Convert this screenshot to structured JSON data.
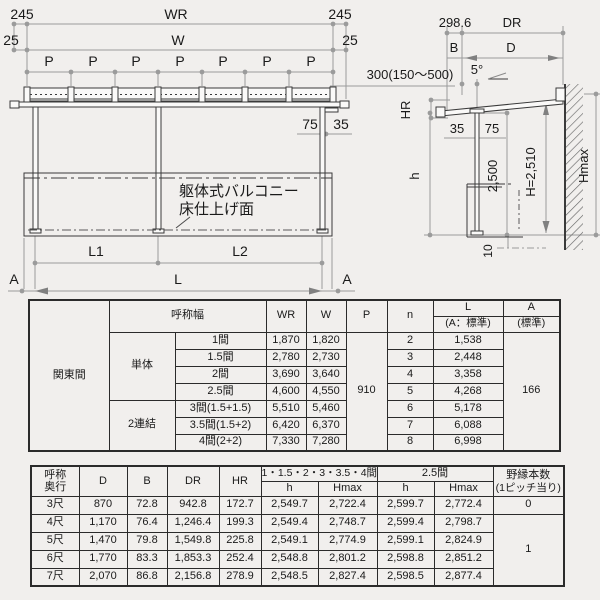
{
  "colors": {
    "structure_line": "#3a3a3a",
    "dimension_line": "#9b9b9b",
    "text": "#1a1a1a",
    "background": "#f1efed",
    "table_border": "#2b2b2b"
  },
  "front_view": {
    "dim_245_left": "245",
    "dim_wr": "WR",
    "dim_245_right": "245",
    "dim_25_left": "25",
    "dim_w": "W",
    "dim_25_right": "25",
    "pitch_label": "P",
    "dim_75": "75",
    "dim_35": "35",
    "note_line1": "躯体式バルコニー",
    "note_line2": "床仕上げ面",
    "dim_l1": "L1",
    "dim_l2": "L2",
    "dim_l": "L",
    "section_left": "A",
    "section_right": "A"
  },
  "side_view": {
    "dim_298_6": "298.6",
    "dim_dr": "DR",
    "dim_b": "B",
    "dim_d": "D",
    "dim_bracket": "300(150〜500)",
    "dim_slope": "5°",
    "dim_hr": "HR",
    "dim_35": "35",
    "dim_75": "75",
    "dim_h": "h",
    "dim_2500": "2,500",
    "dim_h2510": "H=2,510",
    "dim_hmax": "Hmax",
    "dim_10": "10"
  },
  "spec_table": {
    "region": "関東間",
    "header": {
      "width_label": "呼称幅",
      "wr": "WR",
      "w": "W",
      "p": "P",
      "n": "n",
      "l": "L",
      "l_sub": "(A：標準)",
      "a": "A",
      "a_sub": "(標準)"
    },
    "group_single": "単体",
    "group_double": "2連結",
    "p_value": "910",
    "a_value": "166",
    "rows": [
      {
        "size": "1間",
        "wr": "1,870",
        "w": "1,820",
        "n": "2",
        "l": "1,538"
      },
      {
        "size": "1.5間",
        "wr": "2,780",
        "w": "2,730",
        "n": "3",
        "l": "2,448"
      },
      {
        "size": "2間",
        "wr": "3,690",
        "w": "3,640",
        "n": "4",
        "l": "3,358"
      },
      {
        "size": "2.5間",
        "wr": "4,600",
        "w": "4,550",
        "n": "5",
        "l": "4,268"
      },
      {
        "size": "3間(1.5+1.5)",
        "wr": "5,510",
        "w": "5,460",
        "n": "6",
        "l": "5,178"
      },
      {
        "size": "3.5間(1.5+2)",
        "wr": "6,420",
        "w": "6,370",
        "n": "7",
        "l": "6,088"
      },
      {
        "size": "4間(2+2)",
        "wr": "7,330",
        "w": "7,280",
        "n": "8",
        "l": "6,998"
      }
    ]
  },
  "depth_table": {
    "header": {
      "depth_line1": "呼称",
      "depth_line2": "奥行",
      "d": "D",
      "b": "B",
      "dr": "DR",
      "hr": "HR",
      "group1": "1・1.5・2・3・3.5・4間",
      "group2": "2.5間",
      "h": "h",
      "hmax": "Hmax",
      "nobuchi_line1": "野縁本数",
      "nobuchi_line2": "(1ピッチ当り)"
    },
    "nobuchi_merged": "1",
    "rows": [
      {
        "depth": "3尺",
        "d": "870",
        "b": "72.8",
        "dr": "942.8",
        "hr": "172.7",
        "h1": "2,549.7",
        "hmax1": "2,722.4",
        "h2": "2,599.7",
        "hmax2": "2,772.4",
        "nobuchi": "0"
      },
      {
        "depth": "4尺",
        "d": "1,170",
        "b": "76.4",
        "dr": "1,246.4",
        "hr": "199.3",
        "h1": "2,549.4",
        "hmax1": "2,748.7",
        "h2": "2,599.4",
        "hmax2": "2,798.7"
      },
      {
        "depth": "5尺",
        "d": "1,470",
        "b": "79.8",
        "dr": "1,549.8",
        "hr": "225.8",
        "h1": "2,549.1",
        "hmax1": "2,774.9",
        "h2": "2,599.1",
        "hmax2": "2,824.9"
      },
      {
        "depth": "6尺",
        "d": "1,770",
        "b": "83.3",
        "dr": "1,853.3",
        "hr": "252.4",
        "h1": "2,548.8",
        "hmax1": "2,801.2",
        "h2": "2,598.8",
        "hmax2": "2,851.2"
      },
      {
        "depth": "7尺",
        "d": "2,070",
        "b": "86.8",
        "dr": "2,156.8",
        "hr": "278.9",
        "h1": "2,548.5",
        "hmax1": "2,827.4",
        "h2": "2,598.5",
        "hmax2": "2,877.4"
      }
    ]
  }
}
